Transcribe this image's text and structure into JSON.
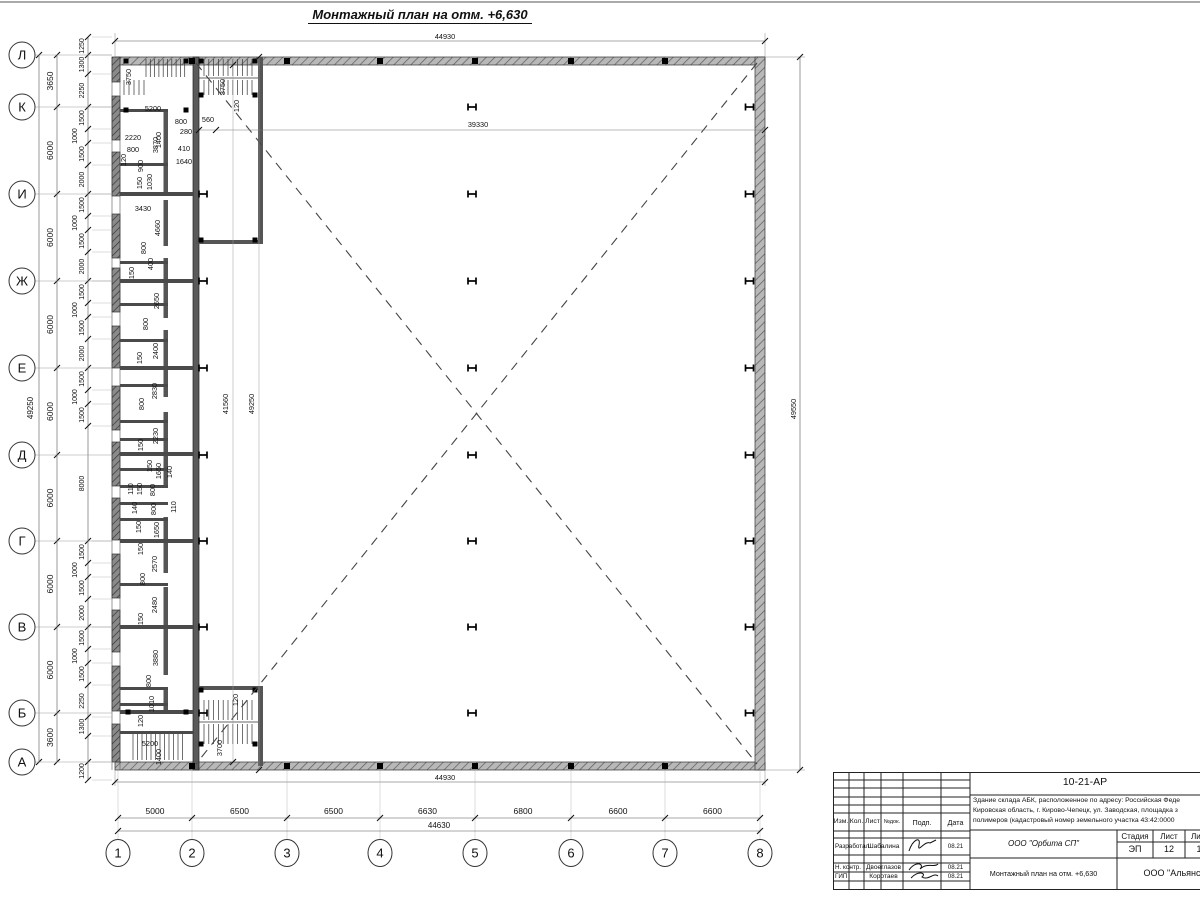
{
  "title": "Монтажный план на отм. +6,630",
  "colors": {
    "line": "#1a1a1a",
    "wall": "#b8b8b8",
    "pier": "#8a8a8a",
    "inner_wall": "#5a5a5a"
  },
  "column_symbol": "H",
  "axes": {
    "rows": [
      "Л",
      "К",
      "И",
      "Ж",
      "Е",
      "Д",
      "Г",
      "В",
      "Б",
      "А"
    ],
    "row_spacings": [
      "3650",
      "6000",
      "6000",
      "6000",
      "6000",
      "6000",
      "6000",
      "6000",
      "3600"
    ],
    "row_total": "49250",
    "cols": [
      "1",
      "2",
      "3",
      "4",
      "5",
      "6",
      "7",
      "8"
    ],
    "col_spacings": [
      "5000",
      "6500",
      "6500",
      "6630",
      "6800",
      "6600",
      "6600"
    ],
    "col_total": "44630",
    "left_chain": [
      "1250",
      "1300",
      "2250",
      "1500",
      "1000",
      "1500",
      "2000",
      "1500",
      "1000",
      "1500",
      "2000",
      "1500",
      "1000",
      "1500",
      "2000",
      "1500",
      "1000",
      "1500",
      "8000",
      "1500",
      "1000",
      "1500",
      "2000",
      "1500",
      "1000",
      "1500",
      "2250",
      "1300",
      "",
      "1200"
    ]
  },
  "overall_dims": {
    "top": "44930",
    "bottom": "44930",
    "right": "49550",
    "hall_width": "39330",
    "hall_h1": "41560",
    "hall_h2": "49250"
  },
  "plan_labels": [
    {
      "t": "3750",
      "x": 131,
      "y": 77,
      "r": 1
    },
    {
      "t": "5200",
      "x": 153,
      "y": 109
    },
    {
      "t": "1400",
      "x": 161,
      "y": 140,
      "r": 1
    },
    {
      "t": "2220",
      "x": 133,
      "y": 138
    },
    {
      "t": "800",
      "x": 133,
      "y": 150
    },
    {
      "t": "3870",
      "x": 158,
      "y": 145,
      "r": 1
    },
    {
      "t": "120",
      "x": 126,
      "y": 160,
      "r": 1
    },
    {
      "t": "900",
      "x": 143,
      "y": 166,
      "r": 1
    },
    {
      "t": "800",
      "x": 181,
      "y": 122
    },
    {
      "t": "280",
      "x": 186,
      "y": 132
    },
    {
      "t": "560",
      "x": 208,
      "y": 120
    },
    {
      "t": "410",
      "x": 184,
      "y": 149
    },
    {
      "t": "1640",
      "x": 184,
      "y": 162
    },
    {
      "t": "3750",
      "x": 225,
      "y": 87,
      "r": 1
    },
    {
      "t": "120",
      "x": 239,
      "y": 106,
      "r": 1
    },
    {
      "t": "150",
      "x": 142,
      "y": 183,
      "r": 1
    },
    {
      "t": "1030",
      "x": 152,
      "y": 182,
      "r": 1
    },
    {
      "t": "3430",
      "x": 143,
      "y": 209
    },
    {
      "t": "4660",
      "x": 160,
      "y": 228,
      "r": 1
    },
    {
      "t": "800",
      "x": 146,
      "y": 248,
      "r": 1
    },
    {
      "t": "400",
      "x": 153,
      "y": 264,
      "r": 1
    },
    {
      "t": "150",
      "x": 134,
      "y": 273,
      "r": 1
    },
    {
      "t": "2650",
      "x": 159,
      "y": 301,
      "r": 1
    },
    {
      "t": "800",
      "x": 148,
      "y": 324,
      "r": 1
    },
    {
      "t": "2400",
      "x": 158,
      "y": 351,
      "r": 1
    },
    {
      "t": "150",
      "x": 142,
      "y": 358,
      "r": 1
    },
    {
      "t": "2830",
      "x": 157,
      "y": 391,
      "r": 1
    },
    {
      "t": "800",
      "x": 144,
      "y": 404,
      "r": 1
    },
    {
      "t": "2230",
      "x": 158,
      "y": 436,
      "r": 1
    },
    {
      "t": "150",
      "x": 143,
      "y": 445,
      "r": 1
    },
    {
      "t": "150",
      "x": 152,
      "y": 466,
      "r": 1
    },
    {
      "t": "1650",
      "x": 161,
      "y": 471,
      "r": 1
    },
    {
      "t": "140",
      "x": 172,
      "y": 472,
      "r": 1
    },
    {
      "t": "110",
      "x": 133,
      "y": 489,
      "r": 1
    },
    {
      "t": "150",
      "x": 142,
      "y": 489,
      "r": 1
    },
    {
      "t": "800",
      "x": 155,
      "y": 490,
      "r": 1
    },
    {
      "t": "140",
      "x": 137,
      "y": 508,
      "r": 1
    },
    {
      "t": "800",
      "x": 156,
      "y": 509,
      "r": 1
    },
    {
      "t": "110",
      "x": 176,
      "y": 507,
      "r": 1
    },
    {
      "t": "150",
      "x": 141,
      "y": 527,
      "r": 1
    },
    {
      "t": "1650",
      "x": 159,
      "y": 530,
      "r": 1
    },
    {
      "t": "150",
      "x": 143,
      "y": 549,
      "r": 1
    },
    {
      "t": "2570",
      "x": 157,
      "y": 564,
      "r": 1
    },
    {
      "t": "800",
      "x": 145,
      "y": 579,
      "r": 1
    },
    {
      "t": "2480",
      "x": 157,
      "y": 605,
      "r": 1
    },
    {
      "t": "150",
      "x": 143,
      "y": 619,
      "r": 1
    },
    {
      "t": "3880",
      "x": 158,
      "y": 658,
      "r": 1
    },
    {
      "t": "800",
      "x": 151,
      "y": 681,
      "r": 1
    },
    {
      "t": "1010",
      "x": 154,
      "y": 704,
      "r": 1
    },
    {
      "t": "120",
      "x": 143,
      "y": 721,
      "r": 1
    },
    {
      "t": "5200",
      "x": 150,
      "y": 744
    },
    {
      "t": "1400",
      "x": 161,
      "y": 757,
      "r": 1
    },
    {
      "t": "3700",
      "x": 222,
      "y": 748,
      "r": 1
    },
    {
      "t": "120",
      "x": 238,
      "y": 700,
      "r": 1
    },
    {
      "t": "39330",
      "x": 478,
      "y": 125
    },
    {
      "t": "41560",
      "x": 228,
      "y": 404,
      "r": 1
    },
    {
      "t": "49250",
      "x": 254,
      "y": 404,
      "r": 1
    },
    {
      "t": "49550",
      "x": 796,
      "y": 409,
      "r": 1
    },
    {
      "t": "44930",
      "x": 445,
      "y": 37
    },
    {
      "t": "44930",
      "x": 445,
      "y": 778
    }
  ],
  "title_block": {
    "code": "10-21-АР",
    "addr1": "Здание склада АБК, расположенное по адресу: Российская Феде",
    "addr2": "Кировская область, г. Кирово-Чепецк, ул. Заводская, площадка з",
    "addr3": "полимеров (кадастровый номер земельного участка 43:42:0000",
    "h_izm": "Изм.",
    "h_kol": "Кол.",
    "h_list": "Лист",
    "h_ndok": "№док.",
    "h_podp": "Подп.",
    "h_data": "Дата",
    "rows": [
      {
        "role": "Разработал",
        "name": "Шабалина",
        "date": "08.21"
      },
      {
        "role": "Н. контр.",
        "name": "Двоеглазов",
        "date": "08.21"
      },
      {
        "role": "ГИП",
        "name": "Коротаев",
        "date": "08.21"
      }
    ],
    "org": "ООО \"Орбита СП\"",
    "st_h": [
      "Стадия",
      "Лист",
      "Листов"
    ],
    "st_v": [
      "ЭП",
      "12",
      "1"
    ],
    "sheet_title": "Монтажный план на отм. +6,630",
    "company": "ООО \"Альянс"
  }
}
